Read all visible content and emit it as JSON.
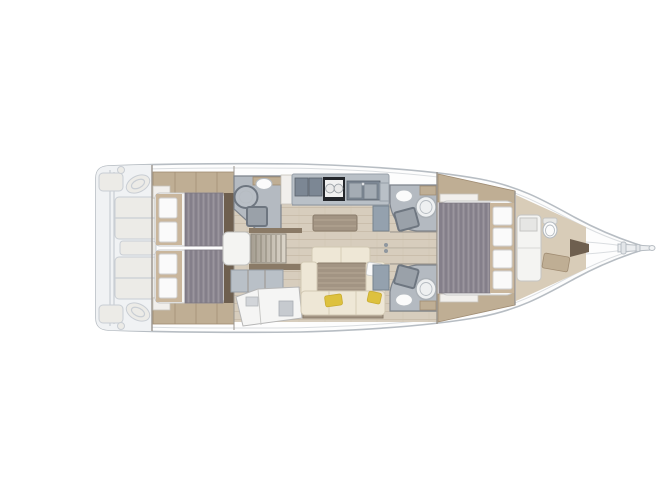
{
  "meta": {
    "kind": "sailboat-interior-floor-plan",
    "view": "top-down",
    "orientation": "bow-right-stern-left"
  },
  "canvas": {
    "width": 667,
    "height": 500
  },
  "colors": {
    "bg": "#ffffff",
    "hull_fill": "#fdfdfd",
    "hull_stroke": "#b7bdc3",
    "hull_inner": "#dadde0",
    "ghost_fill": "#f0f2f4",
    "ghost_stroke": "#c9ced4",
    "ghost_furniture": "#ecebe7",
    "wall": "#9a958e",
    "floor": "#d7cdbd",
    "plank": "#c6baa6",
    "forepeak_floor": "#d8ccb8",
    "sidewood": "#bfae94",
    "sidewood_line": "#a08c72",
    "wood_mid": "#8a7a66",
    "wood_dark": "#6e5f4f",
    "mattress": "#f5f5f3",
    "mattress_stroke": "#c9c9c9",
    "duvet": "#8f8a93",
    "duvet_stripe": "#7d7883",
    "duvet_light": "#9d98a1",
    "pillow": "#fafafa",
    "pillow_stroke": "#cfcfcf",
    "pillow_frame": "#c9b69c",
    "head_floor": "#b4bac1",
    "head_wall": "#7d838b",
    "pan_dark": "#6e7680",
    "pan_mat": "#9aa1a9",
    "fixture": "#fbfbfb",
    "fixture_stroke": "#b6bcc2",
    "counter": "#b9c0c7",
    "counter_stroke": "#98a0a9",
    "unit_dark": "#7c8794",
    "stove": "#23262b",
    "burner": "#e9e9e9",
    "sink": "#a4acb4",
    "steel": "#94a1ae",
    "cream": "#eee7d6",
    "cream_stroke": "#d2c9b4",
    "taupe": "#a29483",
    "taupe_line": "#b5a795",
    "taupe_edge": "#8a7c6b",
    "yellow": "#ddc13e",
    "yellow_stroke": "#c8ab2f",
    "desk_white": "#f5f5f4",
    "desk_stroke": "#b5b5b5",
    "seam": "#beb6a7"
  },
  "areas": [
    {
      "id": "cockpit",
      "label": "cockpit (ghosted)"
    },
    {
      "id": "helm-starboard",
      "label": "starboard helm wheel"
    },
    {
      "id": "helm-port",
      "label": "port helm wheel"
    },
    {
      "id": "aft-cabin-starboard",
      "label": "aft cabin starboard with double berth"
    },
    {
      "id": "aft-cabin-port",
      "label": "aft cabin port with double berth"
    },
    {
      "id": "aft-head",
      "label": "aft head with shower and sink"
    },
    {
      "id": "companionway",
      "label": "companionway steps and engine box"
    },
    {
      "id": "nav-station",
      "label": "navigation station chart table"
    },
    {
      "id": "galley",
      "label": "galley with stove and twin sinks"
    },
    {
      "id": "salon",
      "label": "salon with U-sofa, folding table and bench"
    },
    {
      "id": "head-starboard",
      "label": "starboard en-suite head"
    },
    {
      "id": "head-port",
      "label": "port en-suite head"
    },
    {
      "id": "forward-cabin",
      "label": "forward owner cabin double berth"
    },
    {
      "id": "forepeak-cabin",
      "label": "forepeak crew cabin with berth and toilet"
    },
    {
      "id": "bow-fitting",
      "label": "bowsprit and anchor roller"
    }
  ]
}
